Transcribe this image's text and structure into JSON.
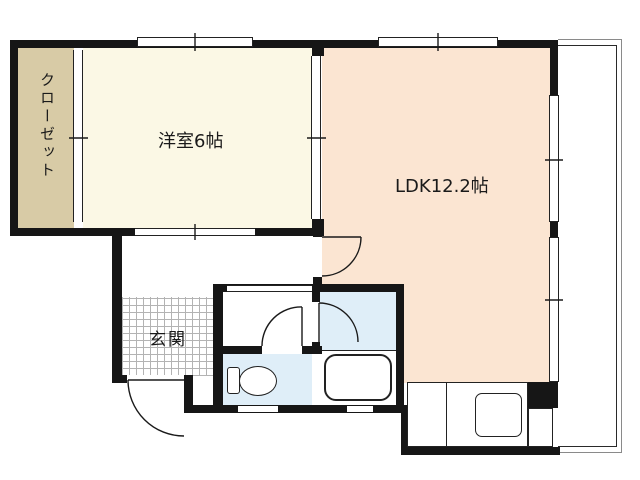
{
  "floorplan": {
    "title": "1LDK apartment floor plan",
    "rooms": [
      {
        "id": "closet",
        "label": "クローゼット"
      },
      {
        "id": "western-room",
        "label": "洋室6帖"
      },
      {
        "id": "ldk",
        "label": "LDK12.2帖"
      },
      {
        "id": "genkan",
        "label": "玄関"
      }
    ],
    "fixtures": [
      {
        "id": "bathtub"
      },
      {
        "id": "toilet"
      },
      {
        "id": "kitchen-counter"
      },
      {
        "id": "stove"
      }
    ],
    "colors": {
      "wall": "#161616",
      "closet_floor": "#d8cba6",
      "western_room_floor": "#fbf8e5",
      "ldk_floor": "#fbe5d2",
      "wet_area_floor": "#dfeef8",
      "tile_grid_line": "#b3b3b3",
      "balcony_outer_line": "#8a8a8a",
      "background": "#ffffff"
    }
  }
}
